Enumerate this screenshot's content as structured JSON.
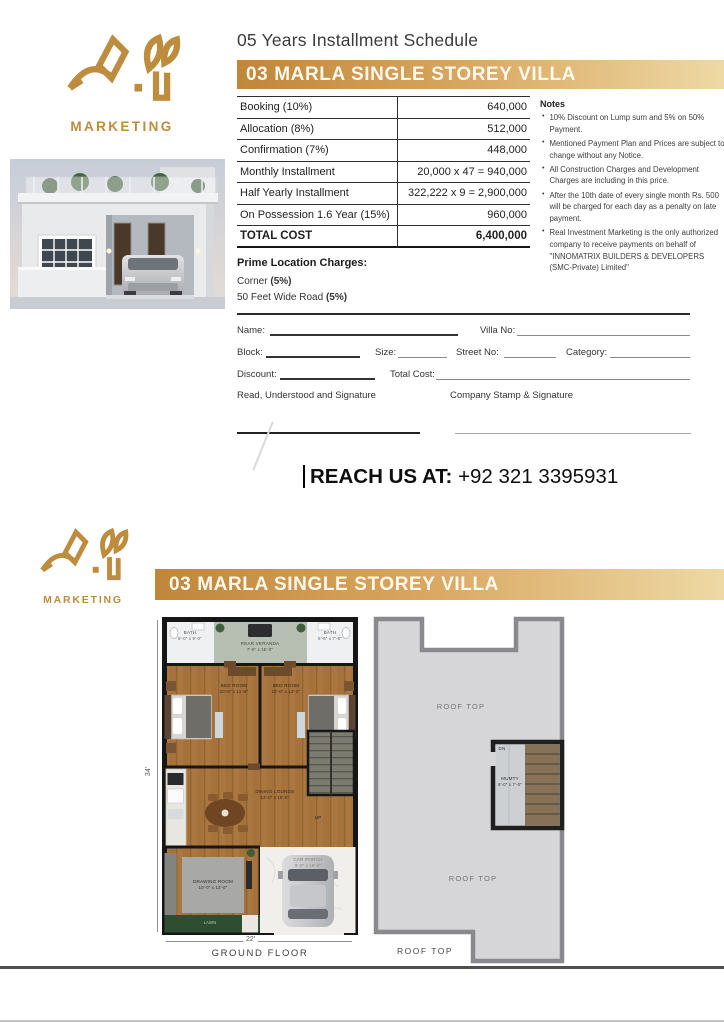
{
  "brand": {
    "monogram": "A.Y",
    "name": "MARKETING",
    "gold": "#bd8c3e"
  },
  "header": {
    "title": "05 Years Installment Schedule",
    "banner": "03 MARLA SINGLE STOREY VILLA"
  },
  "installment_table": {
    "rows": [
      {
        "label": "Booking (10%)",
        "value": "640,000"
      },
      {
        "label": "Allocation (8%)",
        "value": "512,000"
      },
      {
        "label": "Confirmation (7%)",
        "value": "448,000"
      },
      {
        "label": "Monthly Installment",
        "value": "20,000 x 47 = 940,000"
      },
      {
        "label": "Half Yearly Installment",
        "value": "322,222 x 9 = 2,900,000"
      },
      {
        "label": "On Possession 1.6 Year (15%)",
        "value": "960,000"
      }
    ],
    "total": {
      "label": "TOTAL COST",
      "value": "6,400,000"
    }
  },
  "notes": {
    "title": "Notes",
    "items": [
      "10% Discount on Lump sum and 5% on 50% Payment.",
      "Mentioned Payment Plan and Prices are subject to change without any Notice.",
      "All Construction Charges and Development Charges are including in this price.",
      "After the 10th date of every single month Rs. 500 will be charged for each day as a penalty on late payment.",
      "Real Investment Marketing is the only authorized company to receive payments on behalf of \"INNOMATRIX BUILDERS & DEVELOPERS (SMC-Private) Limited\""
    ]
  },
  "prime_location": {
    "title": "Prime Location Charges:",
    "items": [
      {
        "text": "Corner ",
        "bold": "(5%)"
      },
      {
        "text": "50 Feet Wide Road ",
        "bold": "(5%)"
      }
    ]
  },
  "form": {
    "name": "Name:",
    "villa_no": "Villa No:",
    "block": "Block:",
    "size": "Size:",
    "street_no": "Street No:",
    "category": "Category:",
    "discount": "Discount:",
    "total_cost": "Total Cost:",
    "sign_left": "Read, Understood and Signature",
    "sign_right": "Company Stamp & Signature"
  },
  "contact": {
    "label": "REACH US AT:",
    "phone": "+92 321 3395931"
  },
  "floorplan": {
    "banner": "03 MARLA SINGLE STOREY VILLA",
    "ground": {
      "caption": "GROUND FLOOR",
      "dim_width": "22'",
      "dim_height": "34'",
      "rooms": {
        "bath_left": {
          "name": "BATH",
          "size": "6'-0\" x 9'-0\""
        },
        "veranda": {
          "name": "REAR VERANDA",
          "size": "7'-0\" x 15'-0\""
        },
        "bath_right": {
          "name": "BATH",
          "size": "5'-6\" x 7'-6\""
        },
        "bed_left": {
          "name": "BED ROOM",
          "size": "10'-0\" x 11'-6\""
        },
        "bed_right": {
          "name": "BED ROOM",
          "size": "10'-0\" x 12'-0\""
        },
        "dining": {
          "name": "DINING LOUNGE",
          "size": "13'-0\" x 15'-0\""
        },
        "up": "UP",
        "drawing": {
          "name": "DRAWING ROOM",
          "size": "10'-0\" x 13'-0\""
        },
        "porch": {
          "name": "CAR PORCH",
          "size": "9'-0\" x 16'-0\""
        },
        "lawn": {
          "name": "LAWN"
        }
      }
    },
    "roof": {
      "caption": "ROOF TOP",
      "label_top": "ROOF TOP",
      "label_mid": "ROOF TOP",
      "stairs_dn": "DN",
      "mumty": {
        "name": "MUMTY",
        "size": "8'-0\" x 7'-0\""
      }
    }
  },
  "colors": {
    "banner_gold_left": "#c0863a",
    "banner_gold_right": "#eed9a4",
    "logo_gold": "#bd8c3e",
    "wood": "#aa7741",
    "lawn_green": "#2f4d30",
    "roof_gray": "#d6d6d8"
  }
}
